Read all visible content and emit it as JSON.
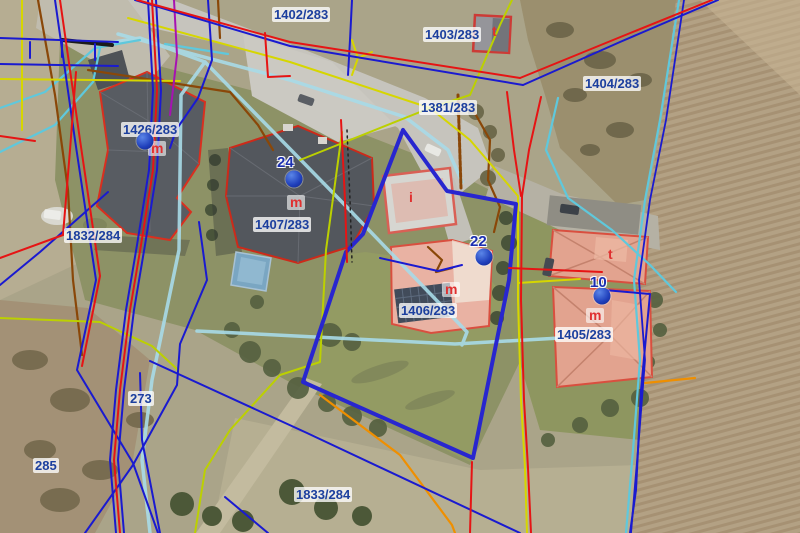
{
  "palette": {
    "boundary_red": "#e61414",
    "line_navy_blue": "#1a1ad0",
    "parcel_thick_blue": "#2826cf",
    "utility_cyan": "#5fc8dc",
    "utility_cyan_pale": "#a8dbe8",
    "utility_yellow": "#d6d600",
    "utility_yellow_green": "#bcd000",
    "utility_orange": "#ef8f00",
    "utility_brown": "#8a4708",
    "utility_magenta": "#a712b2",
    "parcel_label_text": "#1c3f9e",
    "building_letter_red": "#e03030",
    "address_dot_blue": "#2050d0",
    "building_outline_red": "#d92f1f",
    "roof_dark_gray": "#53575d",
    "roof_salmon": "#e2a38f"
  },
  "map": {
    "parcel_labels": [
      {
        "id": "1402-283",
        "text": "1402/283",
        "x": 272,
        "y": 7
      },
      {
        "id": "1403-283",
        "text": "1403/283",
        "x": 423,
        "y": 27
      },
      {
        "id": "1404-283",
        "text": "1404/283",
        "x": 583,
        "y": 76
      },
      {
        "id": "1381-283",
        "text": "1381/283",
        "x": 419,
        "y": 100
      },
      {
        "id": "1426-283",
        "text": "1426/283",
        "x": 121,
        "y": 122
      },
      {
        "id": "1832-284",
        "text": "1832/284",
        "x": 64,
        "y": 228
      },
      {
        "id": "1407-283",
        "text": "1407/283",
        "x": 253,
        "y": 217
      },
      {
        "id": "1406-283",
        "text": "1406/283",
        "x": 399,
        "y": 303
      },
      {
        "id": "1405-283",
        "text": "1405/283",
        "x": 555,
        "y": 327
      },
      {
        "id": "273",
        "text": "273",
        "x": 128,
        "y": 391
      },
      {
        "id": "285",
        "text": "285",
        "x": 33,
        "y": 458
      },
      {
        "id": "1833-284",
        "text": "1833/284",
        "x": 294,
        "y": 487
      }
    ],
    "address_points": [
      {
        "number": "24",
        "dot_x": 294,
        "dot_y": 179,
        "num_x": 277,
        "num_y": 155
      },
      {
        "number": "22",
        "dot_x": 484,
        "dot_y": 257,
        "num_x": 470,
        "num_y": 234
      },
      {
        "number": "10",
        "dot_x": 602,
        "dot_y": 296,
        "num_x": 590,
        "num_y": 275
      },
      {
        "number": "",
        "dot_x": 145,
        "dot_y": 141,
        "num_x": 0,
        "num_y": 0
      }
    ],
    "building_labels": [
      {
        "letter": "m",
        "x": 148,
        "y": 141,
        "boxed": true
      },
      {
        "letter": "m",
        "x": 287,
        "y": 195,
        "boxed": true
      },
      {
        "letter": "m",
        "x": 442,
        "y": 282,
        "boxed": true
      },
      {
        "letter": "m",
        "x": 586,
        "y": 308,
        "boxed": true
      },
      {
        "letter": "t",
        "x": 489,
        "y": 24,
        "boxed": false
      },
      {
        "letter": "t",
        "x": 605,
        "y": 247,
        "boxed": false
      },
      {
        "letter": "i",
        "x": 406,
        "y": 190,
        "boxed": false
      }
    ]
  }
}
